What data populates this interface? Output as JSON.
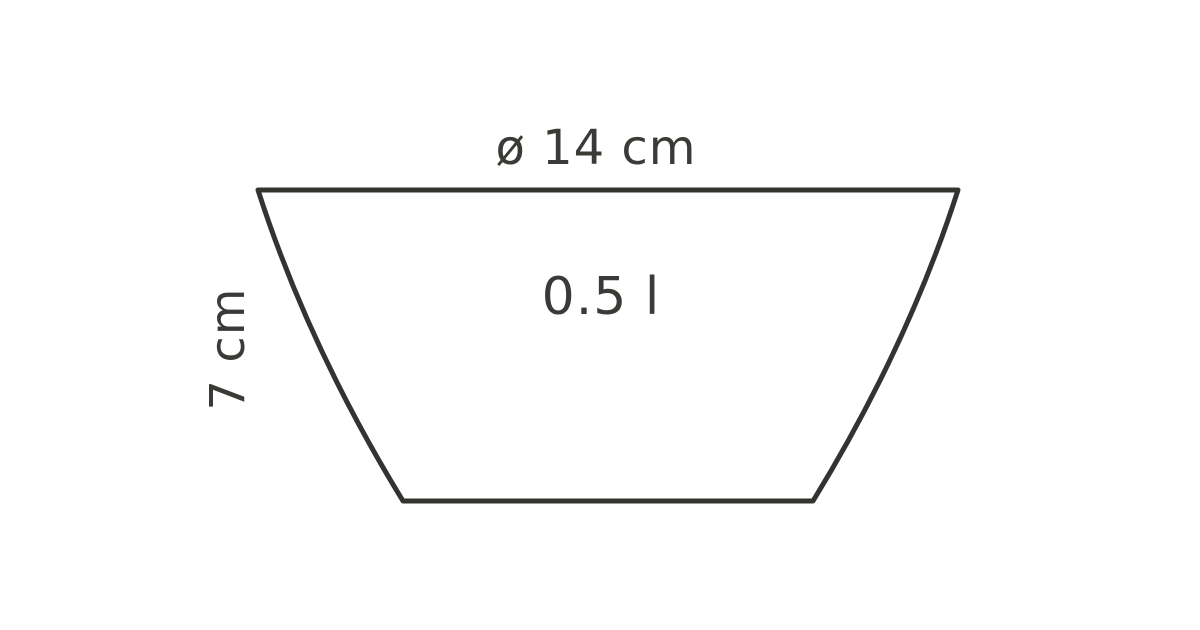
{
  "diagram": {
    "type": "product-dimension-drawing",
    "subject": "bowl-cross-section",
    "diameter_label": "ø 14 cm",
    "height_label": "7 cm",
    "volume_label": "0.5 l"
  },
  "colors": {
    "line": "#333330",
    "text": "#3a3a37",
    "background": "#ffffff"
  }
}
